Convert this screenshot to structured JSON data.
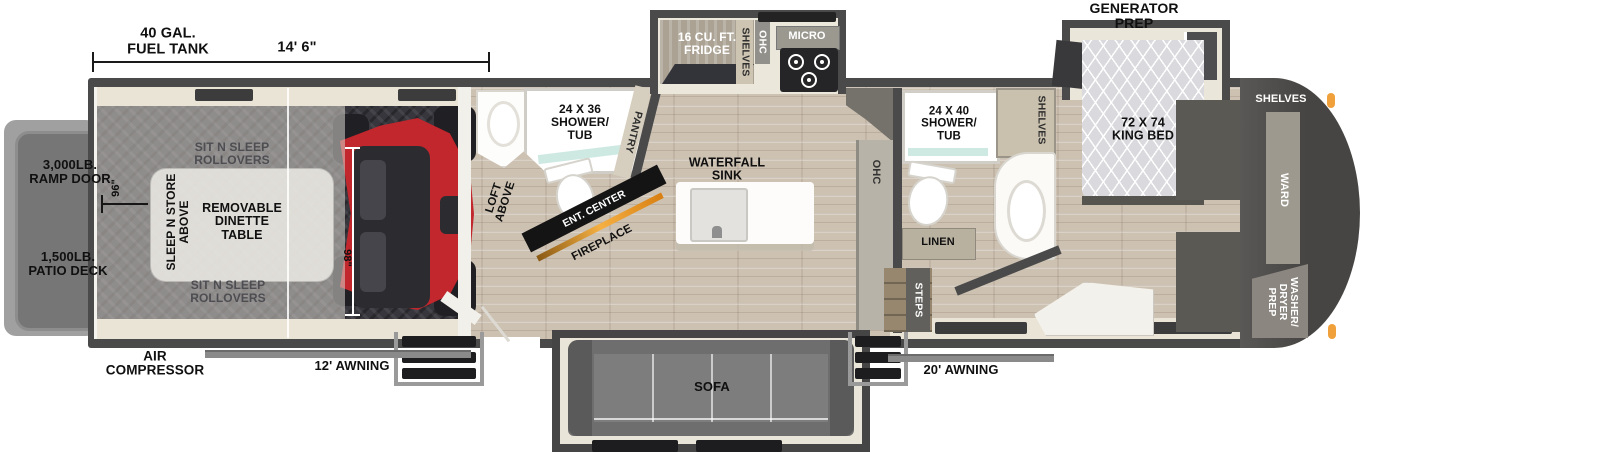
{
  "labels": {
    "fuel_tank": "40 GAL.\nFUEL TANK",
    "garage_length": "14' 6\"",
    "generator_prep": "GENERATOR\nPREP",
    "ramp_door": "3,000LB.\nRAMP DOOR",
    "patio_deck": "1,500LB.\nPATIO DECK",
    "air_compressor": "AIR\nCOMPRESSOR",
    "awning_left": "12' AWNING",
    "awning_right": "20' AWNING",
    "rollovers_top": "SIT N SLEEP\nROLLOVERS",
    "rollovers_bottom": "SIT N SLEEP\nROLLOVERS",
    "sleep_store": "SLEEP N STORE\nABOVE",
    "dinette": "REMOVABLE\nDINETTE\nTABLE",
    "dim_96": "96\"",
    "dim_98": "98\"",
    "loft_above": "LOFT\nABOVE",
    "shower_tub_garage": "24 X 36\nSHOWER/\nTUB",
    "pantry": "PANTRY",
    "ent_center": "ENT. CENTER",
    "fireplace": "FIREPLACE",
    "fridge": "16 CU. FT.\nFRIDGE",
    "shelves_kitchen": "SHELVES",
    "ohc_kitchen": "OHC",
    "micro": "MICRO",
    "waterfall_sink": "WATERFALL\nSINK",
    "sofa": "SOFA",
    "ohc_hall": "OHC",
    "shower_tub_master": "24 X 40\nSHOWER/\nTUB",
    "shelves_bath": "SHELVES",
    "linen": "LINEN",
    "steps": "STEPS",
    "king_bed": "72 X 74\nKING BED",
    "shelves_front": "SHELVES",
    "ward": "WARD",
    "washer_dryer": "WASHER/\nDRYER\nPREP"
  },
  "colors": {
    "wall": "#4a4a4a",
    "accent_red": "#c1272d",
    "wood_floor": "#cdc1b1",
    "garage_floor": "#37363c",
    "slide_floor": "#e9e4d6",
    "marker_light": "#f0a13c"
  }
}
